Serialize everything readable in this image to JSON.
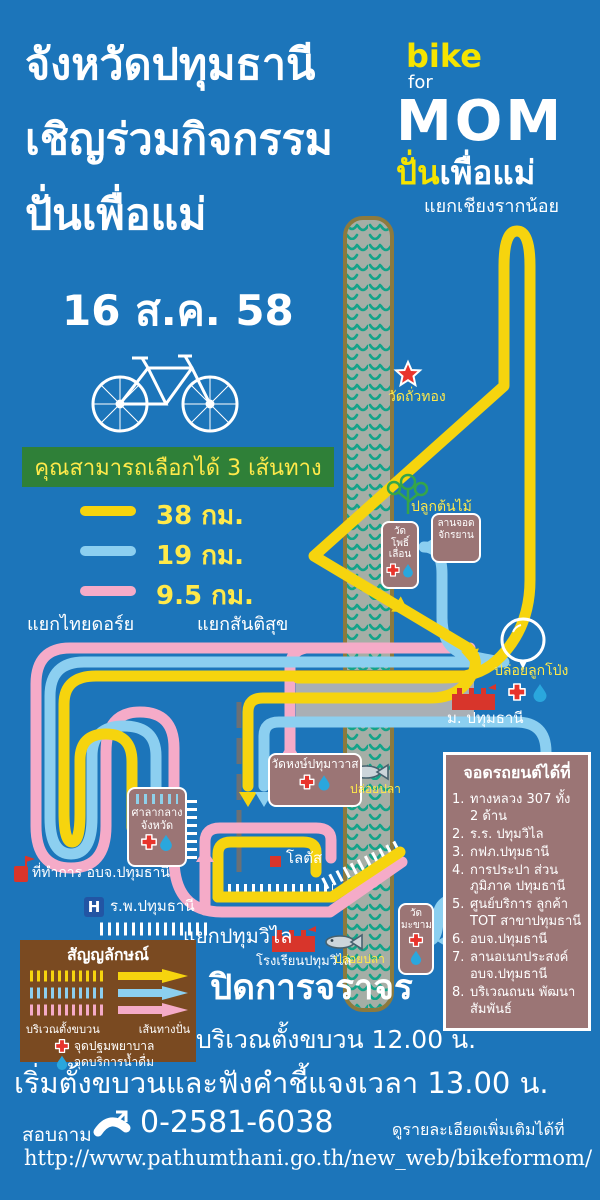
{
  "poster": {
    "title_line1": "จังหวัดปทุมธานี",
    "title_line2": "เชิญร่วมกิจกรรม",
    "title_line3": "ปั่นเพื่อแม่",
    "date": "16 ส.ค. 58",
    "logo": {
      "bike": "bike",
      "for": "for",
      "mom": "MOM",
      "thai_yellow": "ปั่น",
      "thai_white": "เพื่อแม่"
    },
    "route_chooser": {
      "heading": "คุณสามารถเลือกได้ 3 เส้นทาง",
      "routes": [
        {
          "label": "38 กม.",
          "color": "#f6d40e"
        },
        {
          "label": "19 กม.",
          "color": "#8ccff0"
        },
        {
          "label": "9.5 กม.",
          "color": "#f5abc8"
        }
      ]
    },
    "map_labels": {
      "junction_chiang_rak_noi": "แยกเชียงรากน้อย",
      "wat_thua_thong": "วัดถั่วทอง",
      "plant_trees": "ปลูกต้นไม้",
      "bike_parking_line1": "ลานจอด",
      "bike_parking_line2": "จักรยาน",
      "wat_pho_line1": "วัด",
      "wat_pho_line2": "โพธิ์",
      "wat_pho_line3": "เลื่อน",
      "release_balloons": "ปล่อยลูกโป่ง",
      "university": "ม. ปทุมธานี",
      "junction_thai_dory": "แยกไทยดอร์ย",
      "junction_santisuk": "แยกสันติสุข",
      "wat_hong": "วัดหงษ์ปทุมาวาส",
      "release_fish_upper": "ปล่อยปลา",
      "city_hall_line1": "ศาลากลาง",
      "city_hall_line2": "จังหวัด",
      "pao_office": "ที่ทำการ อบจ.ปทุมธานี",
      "hospital_symbol": "H",
      "hospital": "ร.พ.ปทุมธานี",
      "lotus": "โลตัส",
      "junction_pathum_wilai": "แยกปทุมวิไล",
      "school": "โรงเรียนปทุมวิไล",
      "wat_makham_line1": "วัด",
      "wat_makham_line2": "มะขาม",
      "release_fish_lower": "ปล่อยปลา"
    },
    "parking": {
      "title": "จอดรถยนต์ได้ที่",
      "items": [
        {
          "num": "1.",
          "text": "ทางหลวง 307 ทั้ง 2 ด้าน"
        },
        {
          "num": "2.",
          "text": "ร.ร. ปทุมวิไล"
        },
        {
          "num": "3.",
          "text": "กฟภ.ปทุมธานี"
        },
        {
          "num": "4.",
          "text": "การประปา ส่วนภูมิภาค ปทุมธานี"
        },
        {
          "num": "5.",
          "text": "ศูนย์บริการ ลูกค้า TOT สาขาปทุมธานี"
        },
        {
          "num": "6.",
          "text": "อบจ.ปทุมธานี"
        },
        {
          "num": "7.",
          "text": "ลานอเนกประสงค์ อบจ.ปทุมธานี"
        },
        {
          "num": "8.",
          "text": "บริเวณถนน พัฒนาสัมพันธ์"
        }
      ]
    },
    "legend": {
      "title": "สัญญลักษณ์",
      "staging_label": "บริเวณตั้งขบวน",
      "route_label": "เส้นทางปั่น",
      "first_aid": "จุดปฐมพยาบาล",
      "water": "จุดบริการน้ำดื่ม"
    },
    "notices": {
      "closure": "ปิดการจราจร",
      "staging_time": "บริเวณตั้งขบวน 12.00 น.",
      "start_time": "เริ่มตั้งขบวนและฟังคำชี้แจงเวลา 13.00 น."
    },
    "contact": {
      "ask": "สอบถาม",
      "phone": "0-2581-6038",
      "more": "ดูรายละเอียดเพิ่มเติมได้ที่",
      "url": "http://www.pathumthani.go.th/new_web/bikeformom/"
    },
    "colors": {
      "background": "#1c75ba",
      "route_38km": "#f6d40e",
      "route_19km": "#8ccff0",
      "route_9_5km": "#f5abc8",
      "river": "#a5aea6",
      "river_wave": "#14a389",
      "poi_box": "#9b7575",
      "legend_box": "#7a4a21",
      "chooser_box": "#2f8038",
      "accent_yellow_text": "#ffe94a"
    }
  }
}
